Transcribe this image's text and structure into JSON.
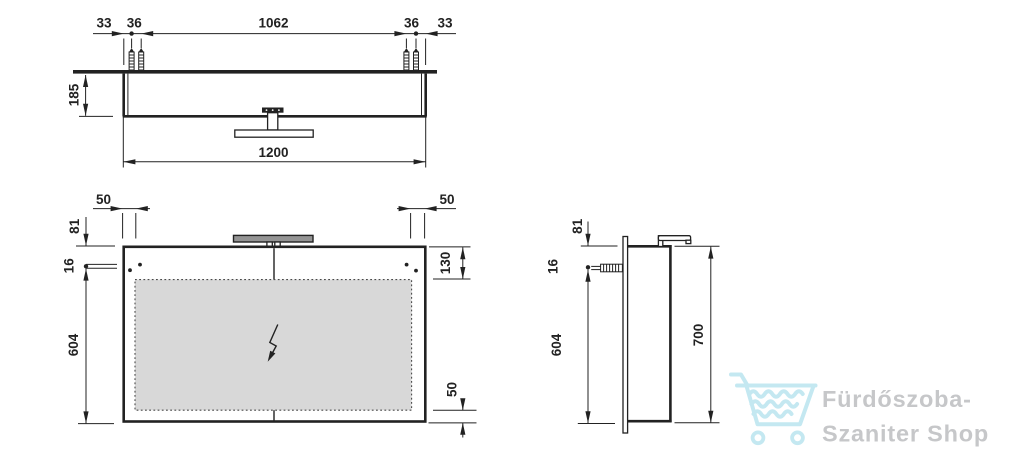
{
  "views": {
    "top": {
      "dims": {
        "edge_to_screw_left": "33",
        "screw_gap_left": "36",
        "screw_span": "1062",
        "screw_gap_right": "36",
        "edge_to_screw_right": "33",
        "depth": "185",
        "overall_width": "1200"
      }
    },
    "front": {
      "dims": {
        "bracket_offset_left": "50",
        "bracket_offset_right": "50",
        "top_to_hole": "81",
        "hole": "16",
        "hole_to_bottom": "604",
        "top_to_glass": "130",
        "glass_to_bottom": "50"
      }
    },
    "side": {
      "dims": {
        "top_to_hole": "81",
        "hole": "16",
        "hole_to_bottom": "604",
        "overall_height": "700"
      }
    }
  },
  "watermark": {
    "icon": "shopping-cart-waves",
    "line1": "Fürdőszoba-",
    "line2": "Szaniter Shop"
  },
  "colors": {
    "line": "#222222",
    "panel-gray": "#d8d8d8",
    "lamp-gray": "#949494",
    "dash": "#4a4a4a",
    "logo-blue": "#c4e8f1",
    "logo-gray": "#c6c7c9"
  }
}
